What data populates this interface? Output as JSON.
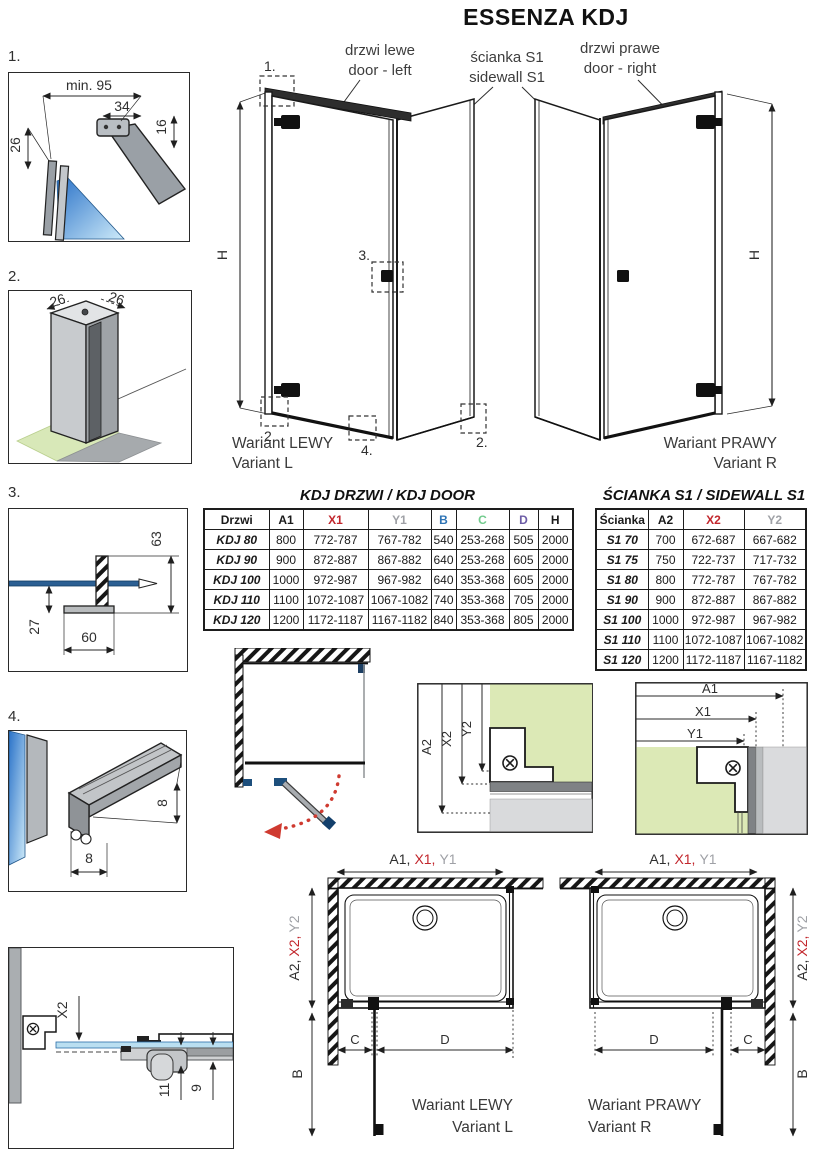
{
  "title": "ESSENZA KDJ",
  "colors": {
    "accent_red": "#c2262c",
    "accent_gray": "#9fa1a6",
    "accent_blue": "#2e74b5",
    "accent_green": "#72cb8d",
    "accent_purple": "#6c5ca6",
    "glass_green": "#dce9b6",
    "glass_blue": "#2a72c8",
    "ink": "#1a1a1a"
  },
  "annotations": {
    "door_left_pl": "drzwi lewe",
    "door_left_en": "door - left",
    "sidewall_pl": "ścianka S1",
    "sidewall_en": "sidewall S1",
    "door_right_pl": "drzwi prawe",
    "door_right_en": "door - right",
    "variant_left_pl": "Wariant LEWY",
    "variant_left_en": "Variant L",
    "variant_right_pl": "Wariant PRAWY",
    "variant_right_en": "Variant R"
  },
  "callouts": {
    "n1": "1.",
    "n2": "2.",
    "n3": "3.",
    "n4": "4."
  },
  "dims": {
    "h": "H",
    "a1": "A1",
    "x1": "X1",
    "y1": "Y1",
    "a2": "A2",
    "x2": "X2",
    "y2": "Y2",
    "b": "B",
    "c": "C",
    "d": "D",
    "a1c": "A1,",
    "x1c": "X1,",
    "a2c": "A2,",
    "x2c": "X2,"
  },
  "details": {
    "d1": {
      "min95": "min. 95",
      "w34": "34",
      "h16": "16",
      "h26": "26"
    },
    "d2": {
      "left26": "26",
      "right26": "26"
    },
    "d3": {
      "h63": "63",
      "h27": "27",
      "w60": "60"
    },
    "d4": {
      "side8": "8",
      "bottom8": "8"
    },
    "d5": {
      "x2": "X2",
      "h11": "11",
      "h9": "9"
    }
  },
  "door_table": {
    "title": "KDJ DRZWI / KDJ DOOR",
    "headers": [
      {
        "t": "Drzwi",
        "c": "#1a1a1a"
      },
      {
        "t": "A1",
        "c": "#1a1a1a"
      },
      {
        "t": "X1",
        "c": "#c2262c"
      },
      {
        "t": "Y1",
        "c": "#9fa1a6"
      },
      {
        "t": "B",
        "c": "#2e74b5"
      },
      {
        "t": "C",
        "c": "#72cb8d"
      },
      {
        "t": "D",
        "c": "#6c5ca6"
      },
      {
        "t": "H",
        "c": "#1a1a1a"
      }
    ],
    "rows": [
      [
        "KDJ 80",
        "800",
        "772-787",
        "767-782",
        "540",
        "253-268",
        "505",
        "2000"
      ],
      [
        "KDJ 90",
        "900",
        "872-887",
        "867-882",
        "640",
        "253-268",
        "605",
        "2000"
      ],
      [
        "KDJ 100",
        "1000",
        "972-987",
        "967-982",
        "640",
        "353-368",
        "605",
        "2000"
      ],
      [
        "KDJ 110",
        "1100",
        "1072-1087",
        "1067-1082",
        "740",
        "353-368",
        "705",
        "2000"
      ],
      [
        "KDJ 120",
        "1200",
        "1172-1187",
        "1167-1182",
        "840",
        "353-368",
        "805",
        "2000"
      ]
    ]
  },
  "sidewall_table": {
    "title": "ŚCIANKA S1 / SIDEWALL S1",
    "headers": [
      {
        "t": "Ścianka",
        "c": "#1a1a1a"
      },
      {
        "t": "A2",
        "c": "#1a1a1a"
      },
      {
        "t": "X2",
        "c": "#c2262c"
      },
      {
        "t": "Y2",
        "c": "#9fa1a6"
      }
    ],
    "rows": [
      [
        "S1 70",
        "700",
        "672-687",
        "667-682"
      ],
      [
        "S1 75",
        "750",
        "722-737",
        "717-732"
      ],
      [
        "S1 80",
        "800",
        "772-787",
        "767-782"
      ],
      [
        "S1 90",
        "900",
        "872-887",
        "867-882"
      ],
      [
        "S1 100",
        "1000",
        "972-987",
        "967-982"
      ],
      [
        "S1 110",
        "1100",
        "1072-1087",
        "1067-1082"
      ],
      [
        "S1 120",
        "1200",
        "1172-1187",
        "1167-1182"
      ]
    ]
  }
}
